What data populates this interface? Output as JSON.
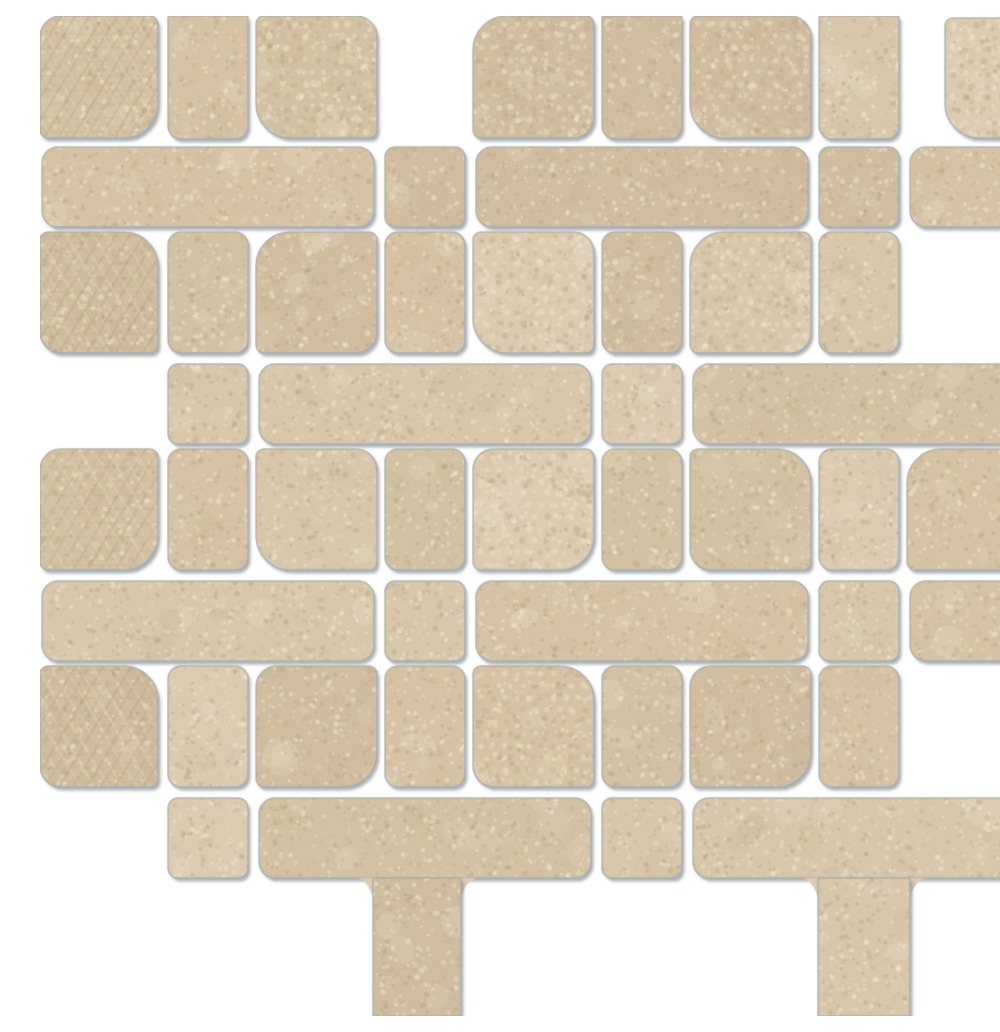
{
  "meta": {
    "description": "Product photo of a beige stone-look retro mosaic tile sheet on white background: interlocking matte porcelain chips (long rounded bars, small squares, arm pieces and rounded-corner patterned decor squares) separated by white grout, sheet cut with a staircase bottom edge and a faint sheet edge line near the right side",
    "canvas": {
      "width": 1000,
      "height": 1000
    },
    "background": "#ffffff"
  },
  "palette": {
    "grout": "#ffffff",
    "bases": [
      "#d8c7ab",
      "#d3c1a3",
      "#dccbb1",
      "#d0bda0",
      "#d6c3a5"
    ],
    "patch_light": "#efe7d2",
    "patch_dark": "#c4b192",
    "speckle_light": "#f6eeda",
    "speckle_dark": "#b7a381",
    "pattern_dot_light": "#eee1c3",
    "pattern_dot_dark": "#c3ae8a",
    "pattern_line": "#b49d75",
    "pattern_line_light": "#ecdfc2",
    "outline": "#a7abad",
    "shadow": "rgba(120,126,130,0.6)",
    "edge_line": "#b5b8ba"
  },
  "geometry": {
    "pitch": 217,
    "track_width": 80,
    "cell_size": 121,
    "grout": 8,
    "bar_length": 332,
    "bar_height": 80,
    "bar_radius": 16,
    "square_size": 80,
    "square_radius": 10,
    "arm_radius": 13,
    "decor_radius_strong": 34,
    "decor_radius_medium": 21,
    "decor_radius_small": 8,
    "edge_line_x": 983,
    "column_flare": 15
  },
  "chips": {
    "h_bars": [
      {
        "x": 2,
        "y": 131,
        "w": 332,
        "h": 80
      },
      {
        "x": 436,
        "y": 131,
        "w": 332,
        "h": 80
      },
      {
        "x": 870,
        "y": 131,
        "w": 115,
        "h": 80
      },
      {
        "x": 219,
        "y": 348,
        "w": 332,
        "h": 80
      },
      {
        "x": 653,
        "y": 348,
        "w": 332,
        "h": 80
      },
      {
        "x": 2,
        "y": 565,
        "w": 332,
        "h": 80
      },
      {
        "x": 436,
        "y": 565,
        "w": 332,
        "h": 80
      },
      {
        "x": 870,
        "y": 565,
        "w": 115,
        "h": 80
      },
      {
        "x": 219,
        "y": 782,
        "w": 332,
        "h": 80
      },
      {
        "x": 653,
        "y": 782,
        "w": 332,
        "h": 80
      }
    ],
    "track_squares": [
      {
        "x": 345,
        "y": 131
      },
      {
        "x": 779,
        "y": 131
      },
      {
        "x": 128,
        "y": 348
      },
      {
        "x": 562,
        "y": 348
      },
      {
        "x": 345,
        "y": 565
      },
      {
        "x": 779,
        "y": 565
      },
      {
        "x": 128,
        "y": 782
      },
      {
        "x": 562,
        "y": 782
      }
    ],
    "track_arms": [
      {
        "x": 128,
        "y": 0,
        "h": 123
      },
      {
        "x": 128,
        "y": 216,
        "h": 121
      },
      {
        "x": 128,
        "y": 433,
        "h": 121
      },
      {
        "x": 128,
        "y": 650,
        "h": 121
      },
      {
        "x": 345,
        "y": 216,
        "h": 121
      },
      {
        "x": 345,
        "y": 433,
        "h": 121
      },
      {
        "x": 345,
        "y": 650,
        "h": 121
      },
      {
        "x": 562,
        "y": 0,
        "h": 123
      },
      {
        "x": 562,
        "y": 216,
        "h": 121
      },
      {
        "x": 562,
        "y": 433,
        "h": 121
      },
      {
        "x": 562,
        "y": 650,
        "h": 121
      },
      {
        "x": 779,
        "y": 0,
        "h": 123
      },
      {
        "x": 779,
        "y": 216,
        "h": 121
      },
      {
        "x": 779,
        "y": 433,
        "h": 121
      },
      {
        "x": 779,
        "y": 650,
        "h": 121
      }
    ],
    "decor_squares": [
      {
        "x": 0,
        "y": 0,
        "w": 118,
        "h": 122,
        "corner": "br",
        "pattern": "weave"
      },
      {
        "x": 216,
        "y": 0,
        "w": 121,
        "h": 122,
        "corner": "bl",
        "pattern": "dots"
      },
      {
        "x": 433,
        "y": 0,
        "w": 121,
        "h": 122,
        "corner": "tl",
        "pattern": "dots"
      },
      {
        "x": 650,
        "y": 0,
        "w": 121,
        "h": 122,
        "corner": "bl",
        "pattern": "dots"
      },
      {
        "x": 905,
        "y": 2,
        "w": 95,
        "h": 120,
        "corner": "bl",
        "pattern": "dots"
      },
      {
        "x": 0,
        "y": 216,
        "w": 118,
        "h": 121,
        "corner": "tr",
        "pattern": "weave"
      },
      {
        "x": 216,
        "y": 216,
        "w": 121,
        "h": 121,
        "corner": "tl",
        "pattern": "plain"
      },
      {
        "x": 433,
        "y": 216,
        "w": 121,
        "h": 121,
        "corner": "bl",
        "pattern": "dots"
      },
      {
        "x": 650,
        "y": 216,
        "w": 121,
        "h": 121,
        "corner": "tl",
        "pattern": "dots"
      },
      {
        "x": 0,
        "y": 433,
        "w": 118,
        "h": 121,
        "corner": "br",
        "pattern": "weave"
      },
      {
        "x": 216,
        "y": 433,
        "w": 121,
        "h": 121,
        "corner": "bl",
        "pattern": "plain"
      },
      {
        "x": 433,
        "y": 433,
        "w": 121,
        "h": 121,
        "corner": "br",
        "pattern": "dots"
      },
      {
        "x": 650,
        "y": 433,
        "w": 121,
        "h": 121,
        "corner": "tr",
        "pattern": "plain"
      },
      {
        "x": 867,
        "y": 433,
        "w": 118,
        "h": 121,
        "corner": "tl",
        "pattern": "plain"
      },
      {
        "x": 0,
        "y": 650,
        "w": 118,
        "h": 121,
        "corner": "tr",
        "pattern": "weave"
      },
      {
        "x": 216,
        "y": 650,
        "w": 121,
        "h": 121,
        "corner": "br",
        "pattern": "plain"
      },
      {
        "x": 433,
        "y": 650,
        "w": 121,
        "h": 121,
        "corner": "tr",
        "pattern": "dots"
      },
      {
        "x": 650,
        "y": 650,
        "w": 121,
        "h": 121,
        "corner": "br",
        "pattern": "plain"
      }
    ],
    "bottom_columns": [
      {
        "x": 333,
        "y": 862,
        "w": 88,
        "h": 138
      },
      {
        "x": 778,
        "y": 862,
        "w": 92,
        "h": 138
      }
    ]
  }
}
